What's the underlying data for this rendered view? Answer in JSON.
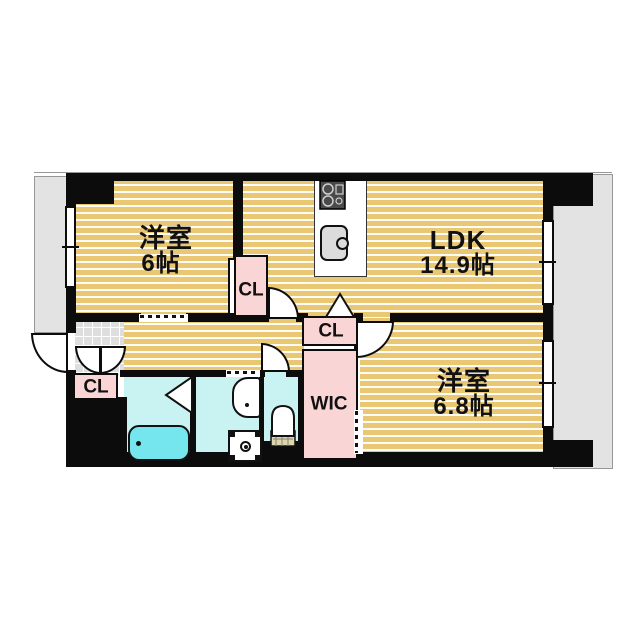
{
  "type": "floor_plan",
  "title": "2LDK apartment floor plan",
  "rooms": {
    "bedroom1": {
      "name": "洋室",
      "size": "6帖"
    },
    "ldk": {
      "name": "LDK",
      "size": "14.9帖"
    },
    "bedroom2": {
      "name": "洋室",
      "size": "6.8帖"
    },
    "closet_bedroom1": {
      "label": "CL"
    },
    "closet_entrance": {
      "label": "CL"
    },
    "closet_ldk": {
      "label": "CL"
    },
    "walk_in_closet": {
      "label": "WIC"
    }
  },
  "icons": {
    "stove": "gas-stove-icon",
    "kitchen_sink": "kitchen-sink-icon",
    "bathtub": "bathtub-icon",
    "washbasin": "washbasin-icon",
    "washing_machine": "washing-machine-pan-icon",
    "toilet": "toilet-icon"
  },
  "colors": {
    "wall": "#0c0c0c",
    "flooring": "#eac873",
    "closet_pink": "#f9d5d5",
    "wet_area_cyan": "#c9f3f3",
    "bathtub_cyan": "#76e6ee",
    "balcony_gray": "#e3e3e3",
    "tile_gray": "#dedede"
  }
}
